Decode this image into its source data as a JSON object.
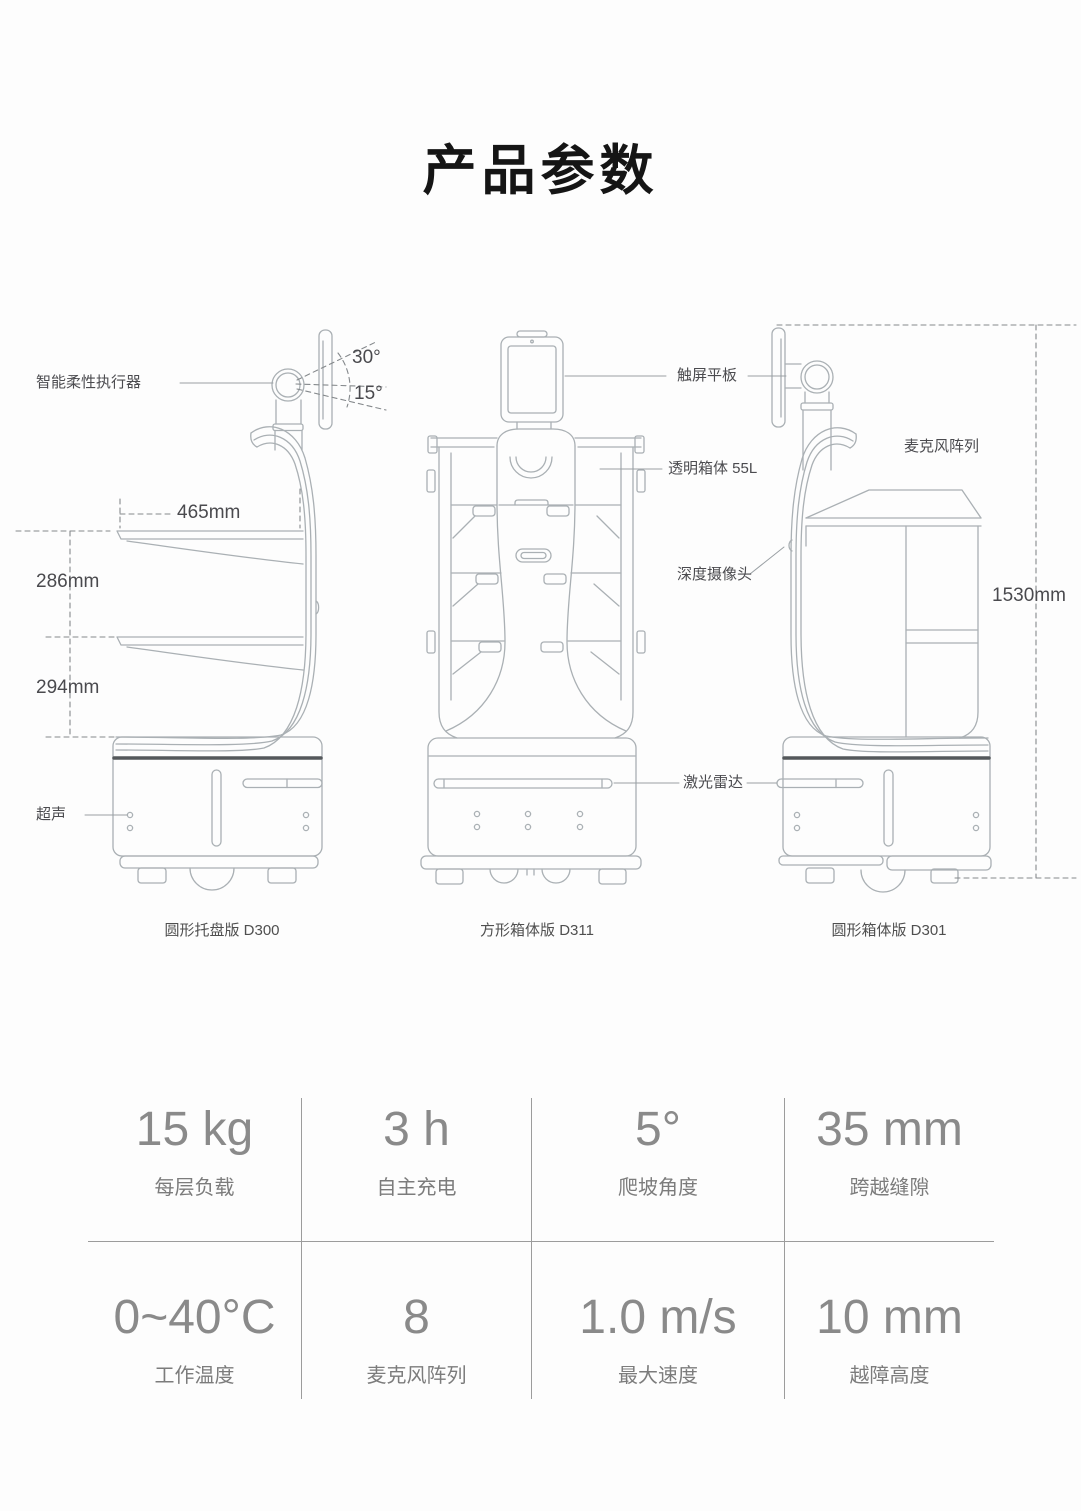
{
  "page": {
    "title": "产品参数",
    "background": "#fdfdfd"
  },
  "diagram": {
    "callouts": {
      "actuator": "智能柔性执行器",
      "ultrasonic": "超声",
      "touchscreen": "触屏平板",
      "transparent_box": "透明箱体 55L",
      "depth_camera": "深度摄像头",
      "lidar": "激光雷达",
      "mic_array": "麦克风阵列"
    },
    "dimensions": {
      "tray_width": "465mm",
      "upper_tray_spacing": "286mm",
      "lower_tray_spacing": "294mm",
      "total_height": "1530mm",
      "screen_tilt_up": "30°",
      "screen_tilt_down": "15°"
    },
    "captions": [
      "圆形托盘版 D300",
      "方形箱体版 D311",
      "圆形箱体版 D301"
    ]
  },
  "specs": [
    {
      "value": "15 kg",
      "label": "每层负载"
    },
    {
      "value": "3 h",
      "label": "自主充电"
    },
    {
      "value": "5°",
      "label": "爬坡角度"
    },
    {
      "value": "35 mm",
      "label": "跨越缝隙"
    },
    {
      "value": "0~40°C",
      "label": "工作温度"
    },
    {
      "value": "8",
      "label": "麦克风阵列"
    },
    {
      "value": "1.0 m/s",
      "label": "最大速度"
    },
    {
      "value": "10 mm",
      "label": "越障高度"
    }
  ]
}
